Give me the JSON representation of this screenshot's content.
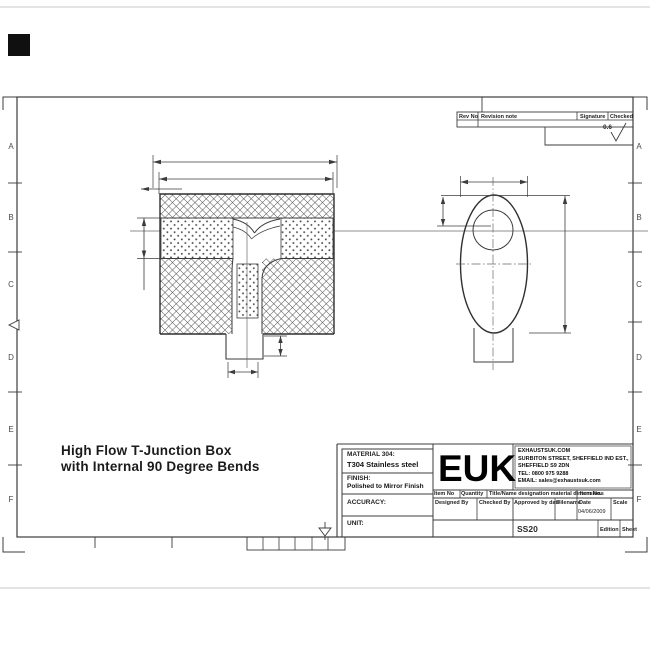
{
  "drawing_title": {
    "line1": "High Flow T-Junction Box",
    "line2": "with Internal 90 Degree Bends"
  },
  "zones": {
    "letters": [
      "A",
      "B",
      "C",
      "D",
      "E",
      "F"
    ]
  },
  "revision_table": {
    "rev_no": "Rev No",
    "revision_note": "Revision note",
    "signature": "Signature",
    "checked": "Checked"
  },
  "surface_finish": {
    "value": "0.6"
  },
  "title_block": {
    "material_label": "MATERIAL 304:",
    "material_value": "T304 Stainless steel",
    "finish_label": "FINISH:",
    "finish_value": "Polished to Mirror Finish",
    "accuracy_label": "ACCURACY:",
    "unit_label": "UNIT:",
    "logo": "EUK",
    "company_lines": [
      "EXHAUSTSUK.COM",
      "SURBITON STREET, SHEFFIELD IND EST.,",
      "SHEFFIELD S9 2DN",
      "TEL: 0800 975 9288",
      "EMAIL: sales@exhaustsuk.com"
    ],
    "row1": [
      "Item No",
      "Quantity",
      "Title/Name designation material dimensions",
      "Item No."
    ],
    "row2": [
      "Designed By",
      "Checked By",
      "Approved by date",
      "Filename",
      "Date",
      "Scale"
    ],
    "date_value": "04/06/2009",
    "drawing_number": "SS20",
    "edition_label": "Edition",
    "sheet_label": "Sheet"
  },
  "colors": {
    "paper": "#ffffff",
    "line": "#3c3c3c",
    "faint_line": "#c9c9c9",
    "print_mark": "#101010"
  }
}
